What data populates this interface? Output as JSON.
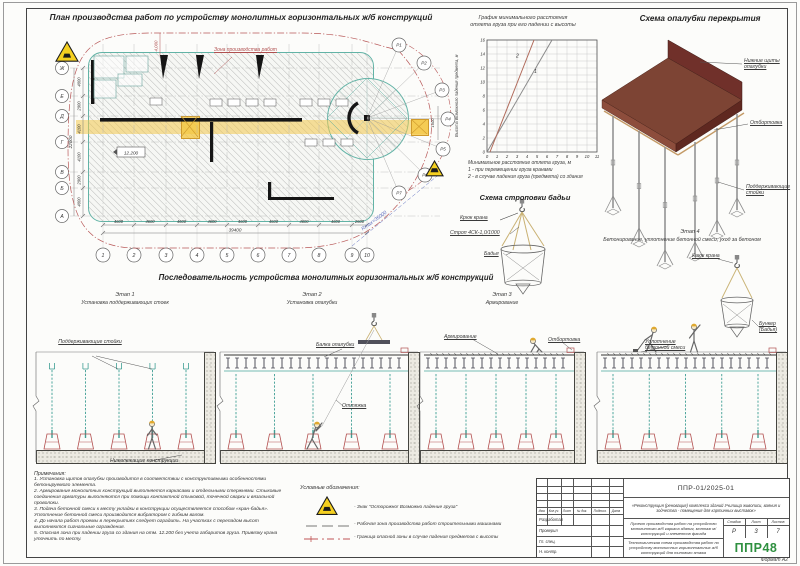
{
  "sheet": {
    "format_label": "Формат А2"
  },
  "plan": {
    "title": "План производства работ по устройству монолитных горизонтальных ж/б конструкций",
    "zone_label": "Зона производства работ",
    "elevation": "12.200",
    "axes_letters": [
      "Ж",
      "Е",
      "Д",
      "Г",
      "В",
      "Б",
      "А"
    ],
    "axes_numbers": [
      "1",
      "2",
      "3",
      "4",
      "5",
      "6",
      "7",
      "8",
      "9",
      "10"
    ],
    "dims_bottom": [
      "4600",
      "4600",
      "4600",
      "4600",
      "4600",
      "4600",
      "4600",
      "4600",
      "2600"
    ],
    "total_bottom": "39400",
    "dims_left": [
      "4000",
      "2900",
      "4100",
      "4100",
      "2900",
      "4000"
    ],
    "total_left": "22000",
    "top_dim": "4,000",
    "dim_1600": "1600",
    "radius_label": "Rmax=35000",
    "p_markers": [
      "Р1",
      "Р2",
      "Р3",
      "Р4",
      "Р5",
      "Р6",
      "Р7"
    ]
  },
  "chart_block": {
    "title_line1": "График минимального расстояния",
    "title_line2": "отлета груза при его падении с высоты",
    "caption": "Минимальное расстояние отлета груза, м",
    "legend1": "1 - при перемещении груза кранами",
    "legend2": "2 - в случае падения груза (предмета) со здания"
  },
  "chart_data": {
    "type": "line",
    "title": "График минимального расстояния отлета груза при его падении с высоты",
    "xlabel": "Минимальное расстояние отлета груза, м",
    "ylabel": "Высота возможного падения предмета, м",
    "xlim": [
      0,
      11
    ],
    "ylim": [
      0,
      16
    ],
    "xticks": [
      0,
      1,
      2,
      3,
      4,
      5,
      6,
      7,
      8,
      9,
      10,
      11
    ],
    "yticks": [
      0,
      2,
      4,
      6,
      8,
      10,
      12,
      14,
      16
    ],
    "grid": true,
    "series": [
      {
        "name": "1 - при перемещении груза кранами",
        "label": "1",
        "points": [
          [
            0,
            0
          ],
          [
            6.5,
            16
          ]
        ],
        "color": "#8a8a8a",
        "label_at": [
          4.7,
          11.3
        ]
      },
      {
        "name": "2 - в случае падения груза (предмета) со здания",
        "label": "2",
        "points": [
          [
            0.3,
            0
          ],
          [
            4.7,
            16
          ]
        ],
        "color": "#b06a5a",
        "label_at": [
          2.9,
          13.5
        ]
      }
    ]
  },
  "formwork": {
    "title": "Схема опалубки перекрытия",
    "label_panels": "Нижние щиты опалубки",
    "label_flange": "Отбортовка",
    "label_props": "Поддерживающие стойки"
  },
  "sling": {
    "title": "Схема строповки бадьи",
    "label_hook": "Крюк крана",
    "label_sling": "Строп 4СК-1,0/1000",
    "label_bucket": "Бадья"
  },
  "sequence": {
    "title": "Последовательность устройства монолитных горизонтальных ж/б конструкций",
    "stage1": {
      "name": "Этап 1",
      "caption": "Установка поддерживающих стоек",
      "label_props": "Поддерживающие стойки",
      "label_below": "Нижележащие конструкции"
    },
    "stage2": {
      "name": "Этап 2",
      "caption": "Установка опалубки",
      "label_beam": "Балка опалубки",
      "label_guy": "Оттяжка"
    },
    "stage3": {
      "name": "Этап 3",
      "caption": "Армирование",
      "label_rebar": "Армирование",
      "label_flange": "Отбортовка"
    },
    "stage4": {
      "name": "Этап 4",
      "caption": "Бетонирование, уплотнение бетонной смеси, уход за бетоном",
      "label_hook": "Крюк крана",
      "label_compact": "Уплотнение бетонной смеси",
      "label_bucket": "Бункер (Бадья)"
    }
  },
  "notes": {
    "heading": "Примечания:",
    "items": [
      "1. Установка щитов опалубки производится в соответствии с конструктивными особенностями бетонируемого элемента.",
      "2. Армирование монолитных конструкций выполняется каркасами и отдельными стержнями. Стыковые соединения арматуры выполняются при помощи контактной стыковой, точечной сварки и вязальной проволоки.",
      "3. Подача бетонной смеси к месту укладки в конструкции осуществляется способом «кран-бадья». Уплотнение бетонной смеси производится вибратором с гибким валом.",
      "4. До начала работ проемы в перекрытиях следует оградить. На участках с перепадом высот выполняются сигнальные ограждения.",
      "5. Опасная зона при падении груза со здания на отм. 12.200 без учета габаритов груза. Привязку крана уточнить по месту."
    ]
  },
  "legend": {
    "heading": "Условные обозначения:",
    "items": [
      {
        "icon": "warning-triangle",
        "text": "- Знак \"Осторожно! Возможно падение груза\""
      },
      {
        "icon": "dashed-line",
        "text": "- Рабочая зона производства работ строительными машинами"
      },
      {
        "icon": "danger-boundary-line",
        "text": "- Граница опасной зоны в случае падения предметов с высоты"
      }
    ]
  },
  "titleblock": {
    "doc_number": "ППР-01/2025-01",
    "object_name": "«Реконструкция (реновация) комплекса зданий Училища живописи, ваяния и зодчества - помещения для картинных выставок»",
    "project_name": "Проект производства работ на устройство монолитного ж/б каркаса здания, монтаж м/конструкций и элементов фасада",
    "sheet_name": "Технологическая схема производства работ по устройству монолитных горизонтальных ж/б конструкций для типового этажа",
    "stage_header": "Стадия",
    "list_header": "Лист",
    "lists_header": "Листов",
    "stage_value": "Р",
    "list_value": "3",
    "lists_value": "7",
    "header_cols": [
      "Изм.",
      "Кол.уч.",
      "Лист",
      "№ док.",
      "Подпись",
      "Дата"
    ],
    "roles": [
      "Разработал",
      "Проверил",
      "Гл. спец.",
      "Н. контр."
    ],
    "logo": "ППР48"
  }
}
